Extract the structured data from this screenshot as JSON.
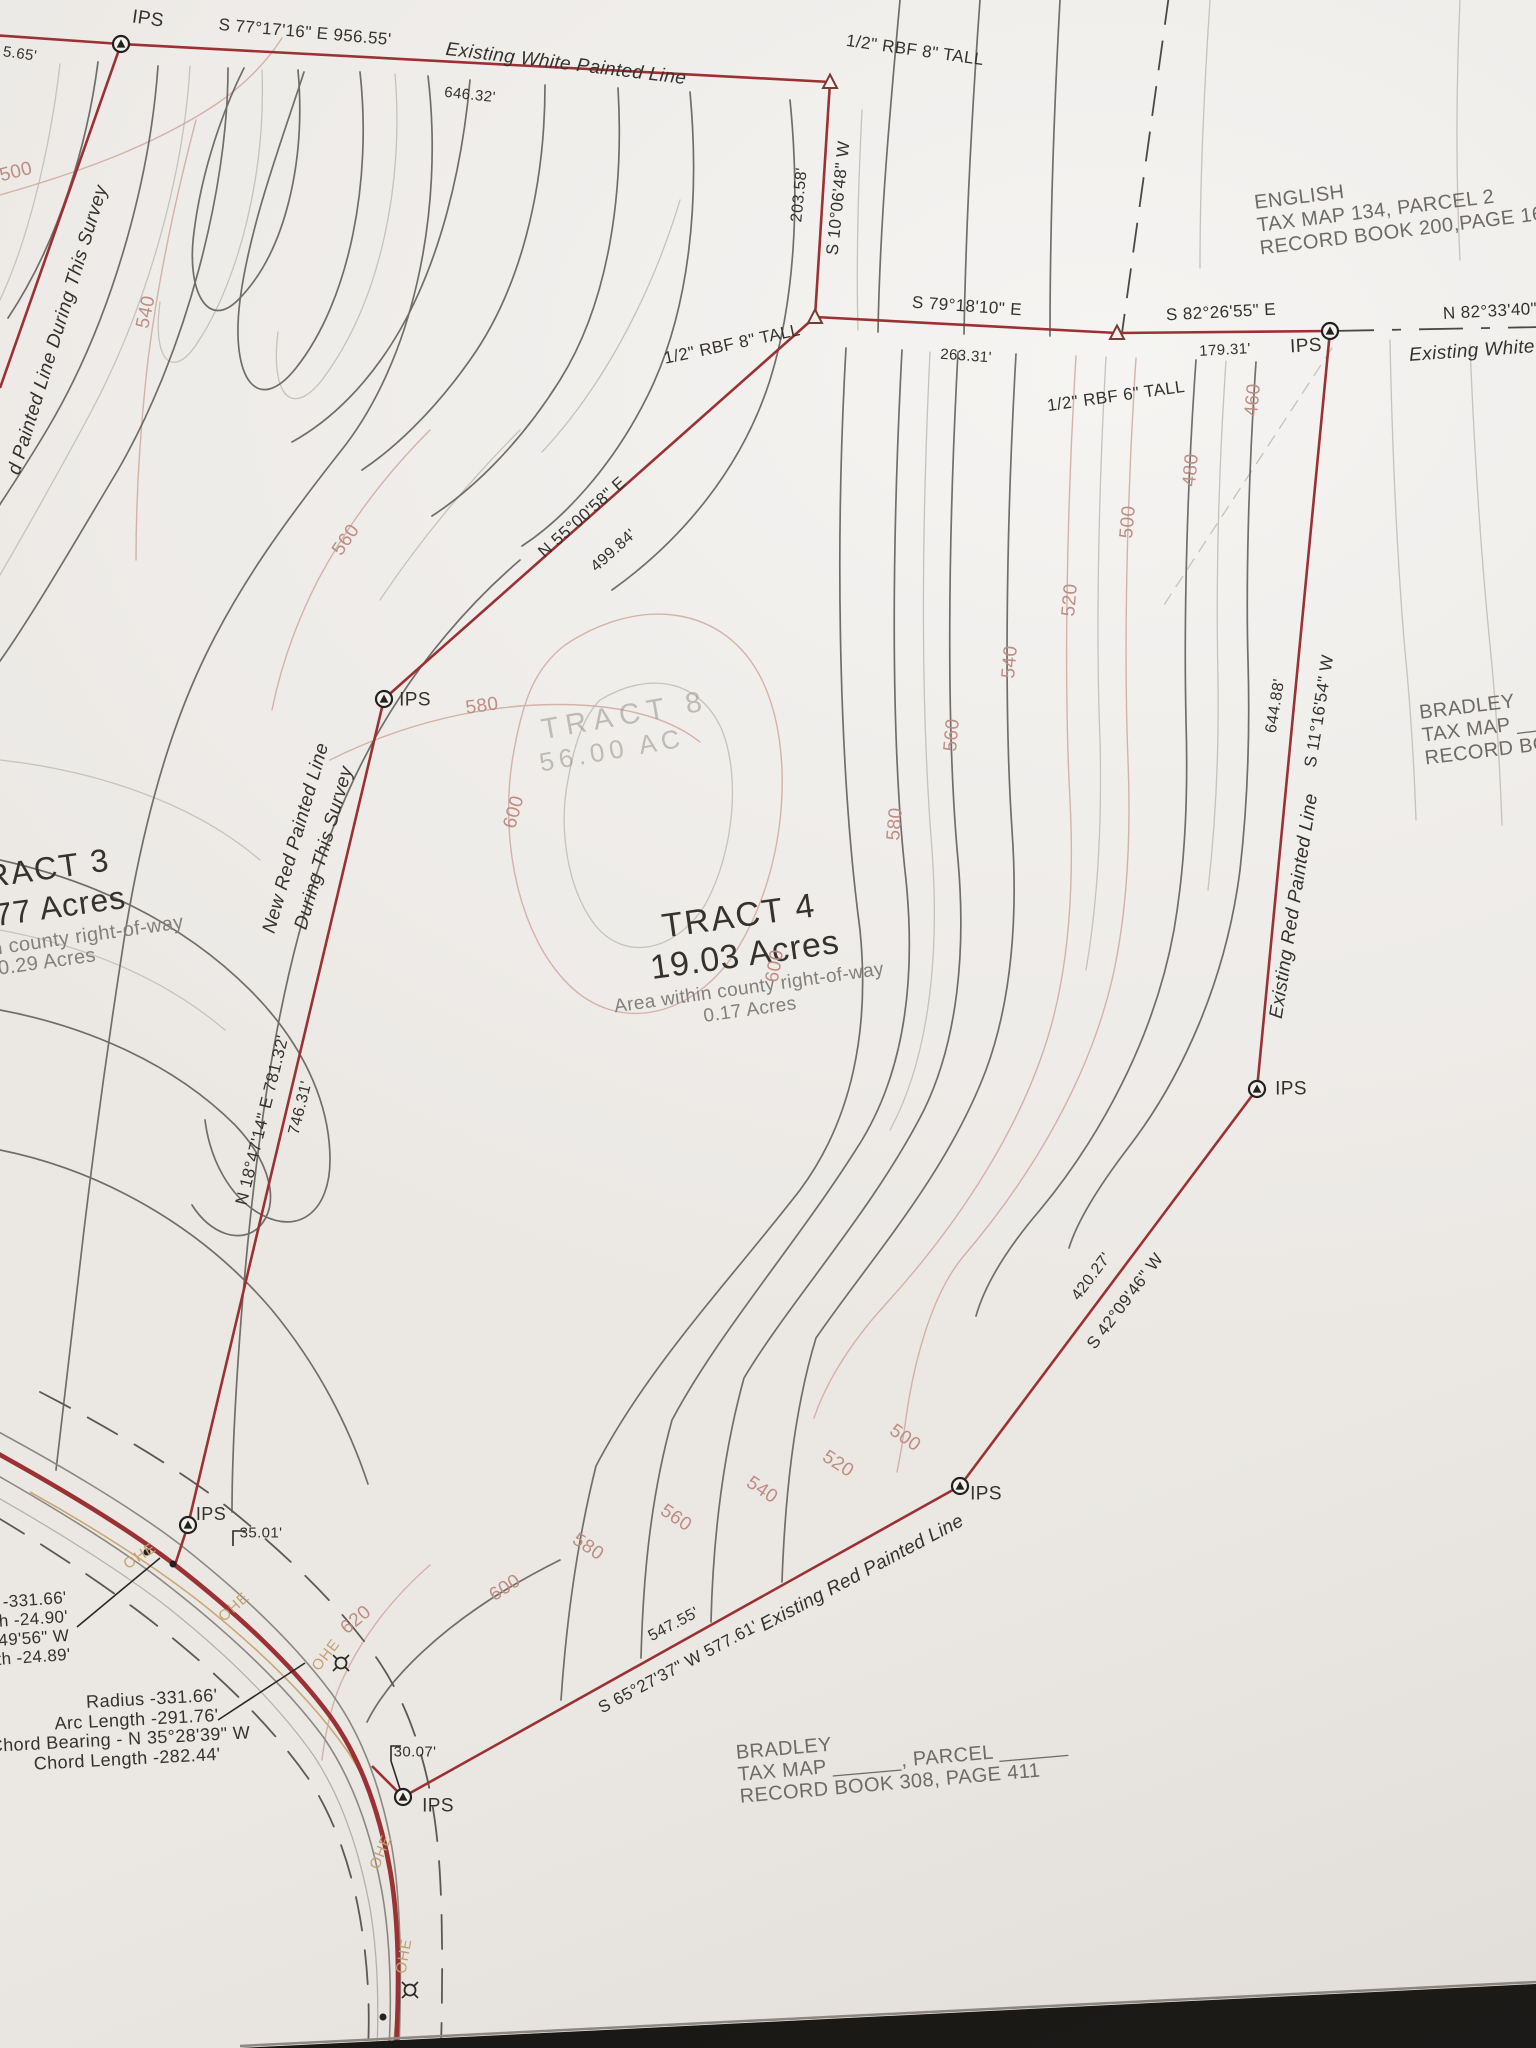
{
  "colors": {
    "boundary_red": "#9c3134",
    "contour_dark": "#615e5a",
    "contour_light": "#c4c0ba",
    "contour_pink": "#c9a49b",
    "text_dark": "#35322e",
    "text_gray": "#83807b",
    "ohe_tan": "#c3a06d",
    "paper": "#f0eeeb"
  },
  "tracts": {
    "tract3": {
      "name_partial": "RACT 3",
      "acres_partial": "77 Acres",
      "note": "in county right-of-way",
      "note_acres": "0.29 Acres"
    },
    "tract4": {
      "name": "TRACT 4",
      "acres": "19.03 Acres",
      "note": "Area within county right-of-way",
      "note_acres": "0.17 Acres"
    },
    "tract8": {
      "name": "TRACT 8",
      "acres": "56.00 AC"
    }
  },
  "adjoiners": {
    "english": {
      "line1": "ENGLISH",
      "line2": "TAX MAP 134, PARCEL 2",
      "line3": "RECORD BOOK 200,PAGE 167"
    },
    "bradley_right": {
      "line1": "BRADLEY",
      "line2": "TAX MAP ________",
      "line3": "RECORD BOO"
    },
    "bradley_bottom": {
      "line1": "BRADLEY",
      "line2": "TAX MAP ______, PARCEL ______",
      "line3": "RECORD BOOK 308, PAGE 411"
    }
  },
  "boundary_labels": {
    "left_cut_dist": "5.65'",
    "top_bearing": "S 77°17'16\" E 956.55'",
    "top_line_name": "Existing  White  Painted  Line",
    "top_dist2": "646.32'",
    "rbf_top": "1/2\" RBF 8\" TALL",
    "east_dist": "203.58'",
    "east_bearing": "S 10°06'48\" W",
    "rbf_mid": "1/2\" RBF 8\" TALL",
    "s79_bearing": "S 79°18'10\" E",
    "s79_dist": "263.31'",
    "rbf_6": "1/2\" RBF 6\" TALL",
    "s82_bearing": "S 82°26'55\" E",
    "s82_dist": "179.31'",
    "n82_bearing": "N 82°33'40\"",
    "white_line_right": "Existing  White",
    "n55_bearing": "N 55°00'58\" E",
    "n55_dist": "499.84'",
    "s11_bearing": "S 11°16'54\" W",
    "s11_dist": "644.88'",
    "red_line_right": "Existing  Red  Painted  Line",
    "s42_bearing": "S 42°09'46\" W",
    "s42_dist": "420.27'",
    "red_line_bottom": "Existing  Red  Painted  Line",
    "s65_bearing": "S 65°27'37\" W 577.61'",
    "s65_dist": "547.55'",
    "n18_bearing": "N 18°47'14\" E 781.32'",
    "n18_dist": "746.31'",
    "new_red_line1": "New Red Painted Line",
    "new_red_line2": "During This Survey",
    "left_steep_label": "d  Painted  Line  During  This  Survey",
    "tick_3501": "35.01'",
    "tick_3007": "30.07'"
  },
  "curve_tables": {
    "main": {
      "l1": "Radius -331.66'",
      "l2": "Arc Length -291.76'",
      "l3": "Chord Bearing - N 35°28'39\" W",
      "l4": "Chord Length -282.44'"
    },
    "left_cut": {
      "l1": "-331.66'",
      "l2": "h -24.90'",
      "l3": "49'56\" W",
      "l4": "th -24.89'"
    }
  },
  "markers": {
    "ips": "IPS"
  },
  "utility": {
    "ohe": "OHE"
  },
  "contour_labels": [
    {
      "v": "500"
    },
    {
      "v": "540"
    },
    {
      "v": "560"
    },
    {
      "v": "580"
    },
    {
      "v": "600"
    },
    {
      "v": "600"
    },
    {
      "v": "460"
    },
    {
      "v": "480"
    },
    {
      "v": "500"
    },
    {
      "v": "520"
    },
    {
      "v": "540"
    },
    {
      "v": "560"
    },
    {
      "v": "580"
    },
    {
      "v": "500"
    },
    {
      "v": "520"
    },
    {
      "v": "540"
    },
    {
      "v": "560"
    },
    {
      "v": "580"
    },
    {
      "v": "600"
    },
    {
      "v": "620"
    }
  ]
}
